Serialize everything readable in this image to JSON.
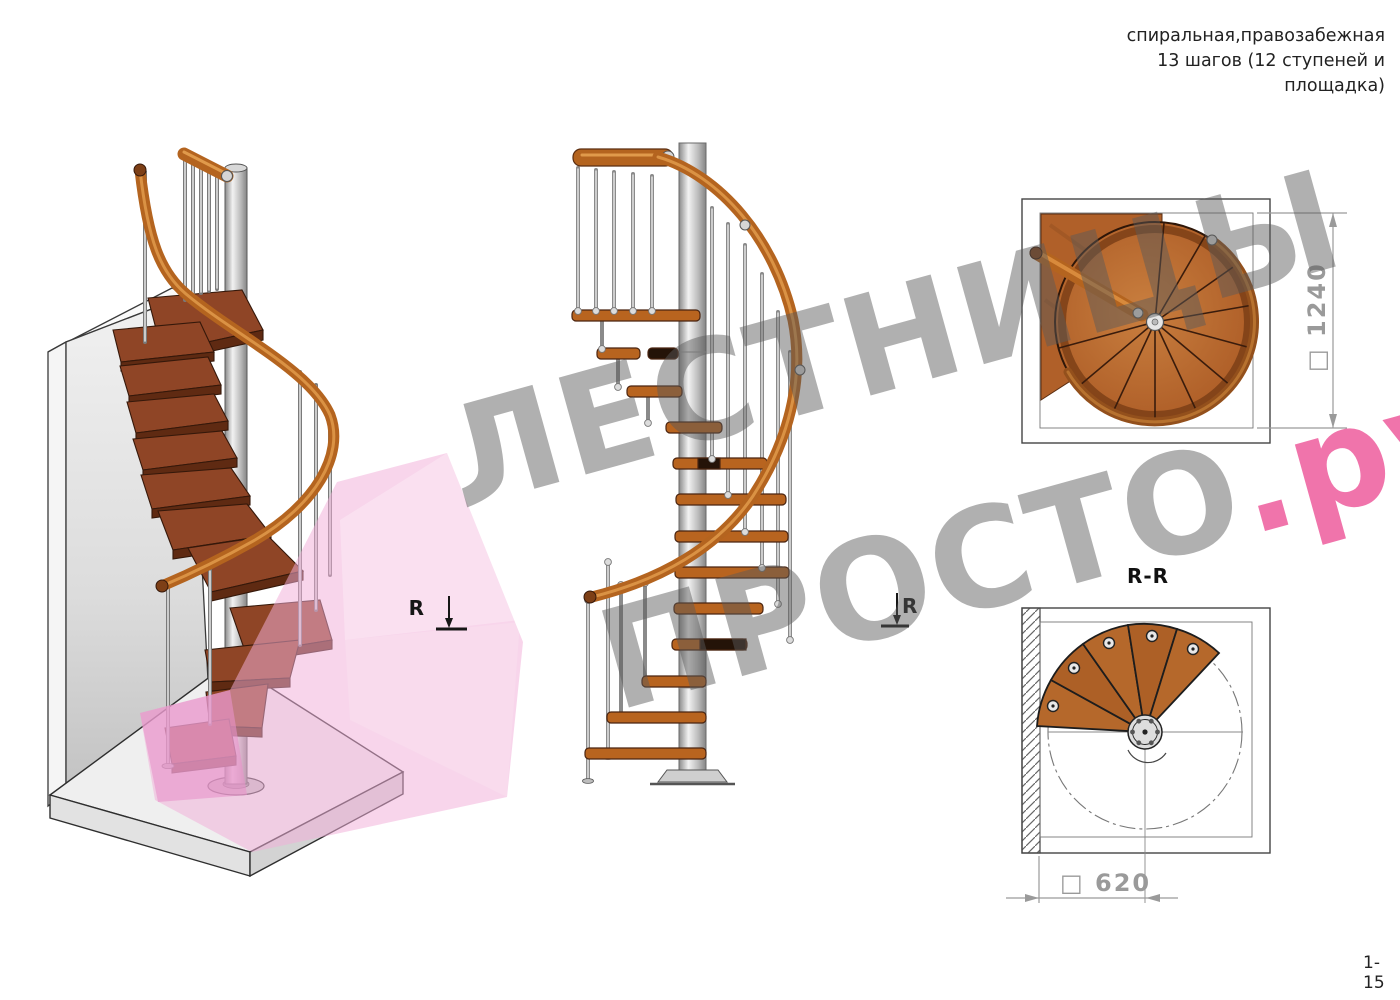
{
  "header": {
    "title_lines": [
      "спиральная,правозабежная",
      "13 шагов (12 ступеней и",
      "площадка)"
    ]
  },
  "footer": {
    "page_number": "1-15"
  },
  "watermark": {
    "line1": "ЛЕСТНИЦЫ",
    "line2_main": "ПРОСТО",
    "line2_accent": ".ру",
    "text_color": "#9a9a9a",
    "accent_color": "#ec3c8c",
    "ribbon_color": "#f2aed8"
  },
  "markers": {
    "letter": "R"
  },
  "views": {
    "plan": {
      "dim_symbol": "□",
      "dim_value": "1240",
      "dim_label": "□ 1240"
    },
    "section": {
      "label": "R-R",
      "dim_symbol": "□",
      "dim_value": "620",
      "dim_label": "□ 620"
    }
  },
  "colors": {
    "wood_step": "#8f4526",
    "wood_rail": "#b4641f",
    "metal": "#c8c8c8",
    "dimension_gray": "#9a9a9a",
    "drawing_line": "#333333"
  }
}
